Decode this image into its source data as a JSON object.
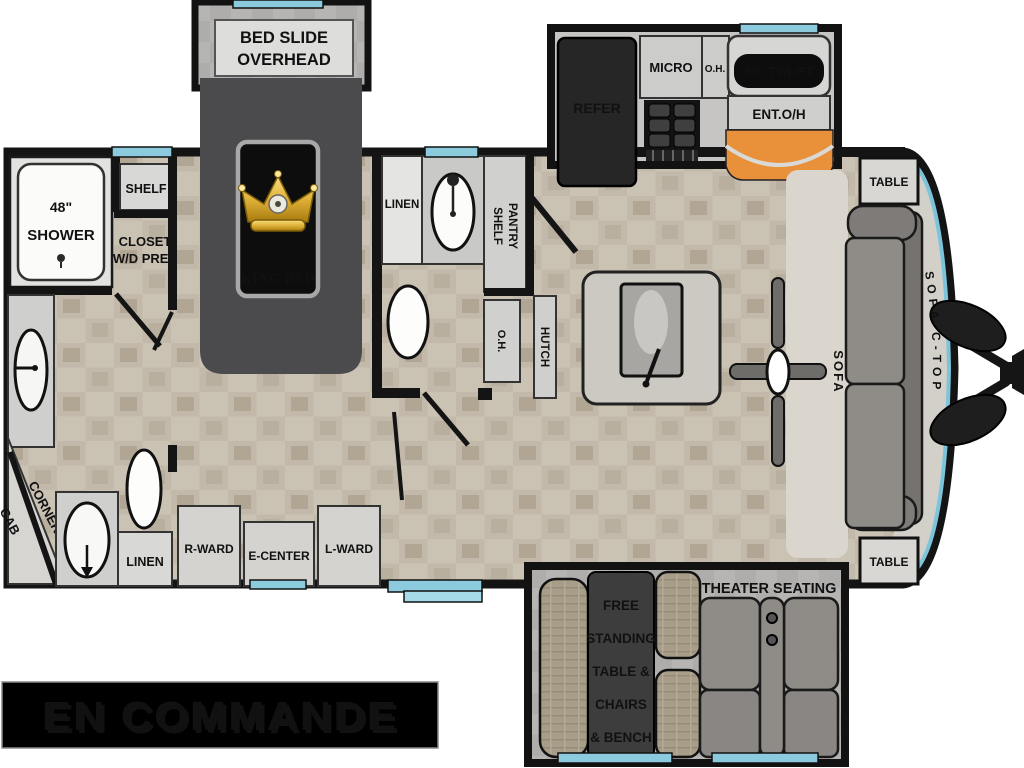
{
  "banner": {
    "text": "EN COMMANDE",
    "bg": "#000000",
    "text_color": "#f4ecdb",
    "shadow_color": "#dd7a22"
  },
  "colors": {
    "window_blue": "#8bcbdd",
    "nose_blue": "#7cc4da",
    "fireplace_orange": "#e8913a",
    "crown_gold": "#d9a62b",
    "wall_black": "#141414"
  },
  "floorplan": {
    "bedroom": {
      "bed_slide_line1": "BED SLIDE",
      "bed_slide_line2": "OVERHEAD",
      "king_bed": "KING BED",
      "shelf": "SHELF",
      "closet_line1": "CLOSET",
      "closet_line2": "W/D PREP",
      "r_ward": "R-WARD",
      "e_center": "E-CENTER",
      "l_ward": "L-WARD"
    },
    "front_bath": {
      "shower_line1": "48\"",
      "shower_line2": "SHOWER",
      "corner_line1": "CORNER",
      "corner_line2": "CAB",
      "linen": "LINEN"
    },
    "master_bath": {
      "linen": "LINEN",
      "pantry_line1": "PANTRY",
      "pantry_line2": "SHELF",
      "oh": "O.H.",
      "hutch": "HUTCH"
    },
    "kitchen": {
      "refer": "REFER",
      "micro": "MICRO",
      "oh": "O.H.",
      "tv": "50\" TV/LIFT",
      "ent_oh": "ENT.O/H"
    },
    "living": {
      "table_front": "TABLE",
      "table_rear": "TABLE",
      "sofa": "SOFA",
      "sofa_ctop": "SOFA C-TOP",
      "theater": "THEATER SEATING",
      "dinette_line1": "FREE",
      "dinette_line2": "STANDING",
      "dinette_line3": "TABLE &",
      "dinette_line4": "CHAIRS",
      "dinette_line5": "& BENCH"
    }
  }
}
